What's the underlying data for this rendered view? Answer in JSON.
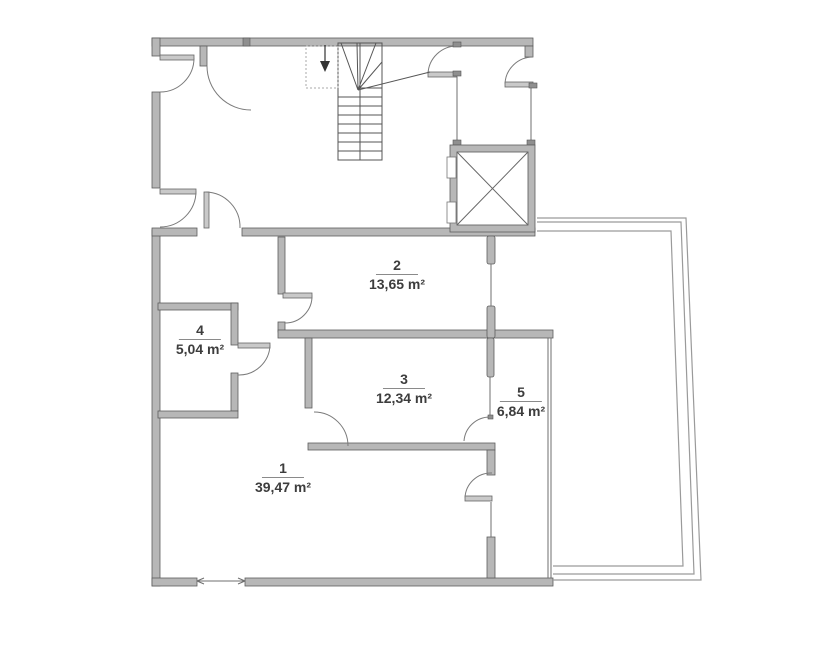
{
  "title": "floor-plan",
  "rooms": [
    {
      "number": "1",
      "area": "39,47 m²"
    },
    {
      "number": "2",
      "area": "13,65 m²"
    },
    {
      "number": "3",
      "area": "12,34 m²"
    },
    {
      "number": "4",
      "area": "5,04 m²"
    },
    {
      "number": "5",
      "area": "6,84 m²"
    }
  ],
  "features": {
    "staircase": "staircase-with-winders",
    "elevator": "elevator-shaft-x",
    "terrace": "terrace-outline"
  },
  "colors": {
    "wall_fill": "#b7b7b7",
    "wall_stroke": "#5d5d5d",
    "thin_line": "#6f6f6f",
    "terrace_line": "#9a9a9a",
    "text": "#3d3d3d"
  }
}
